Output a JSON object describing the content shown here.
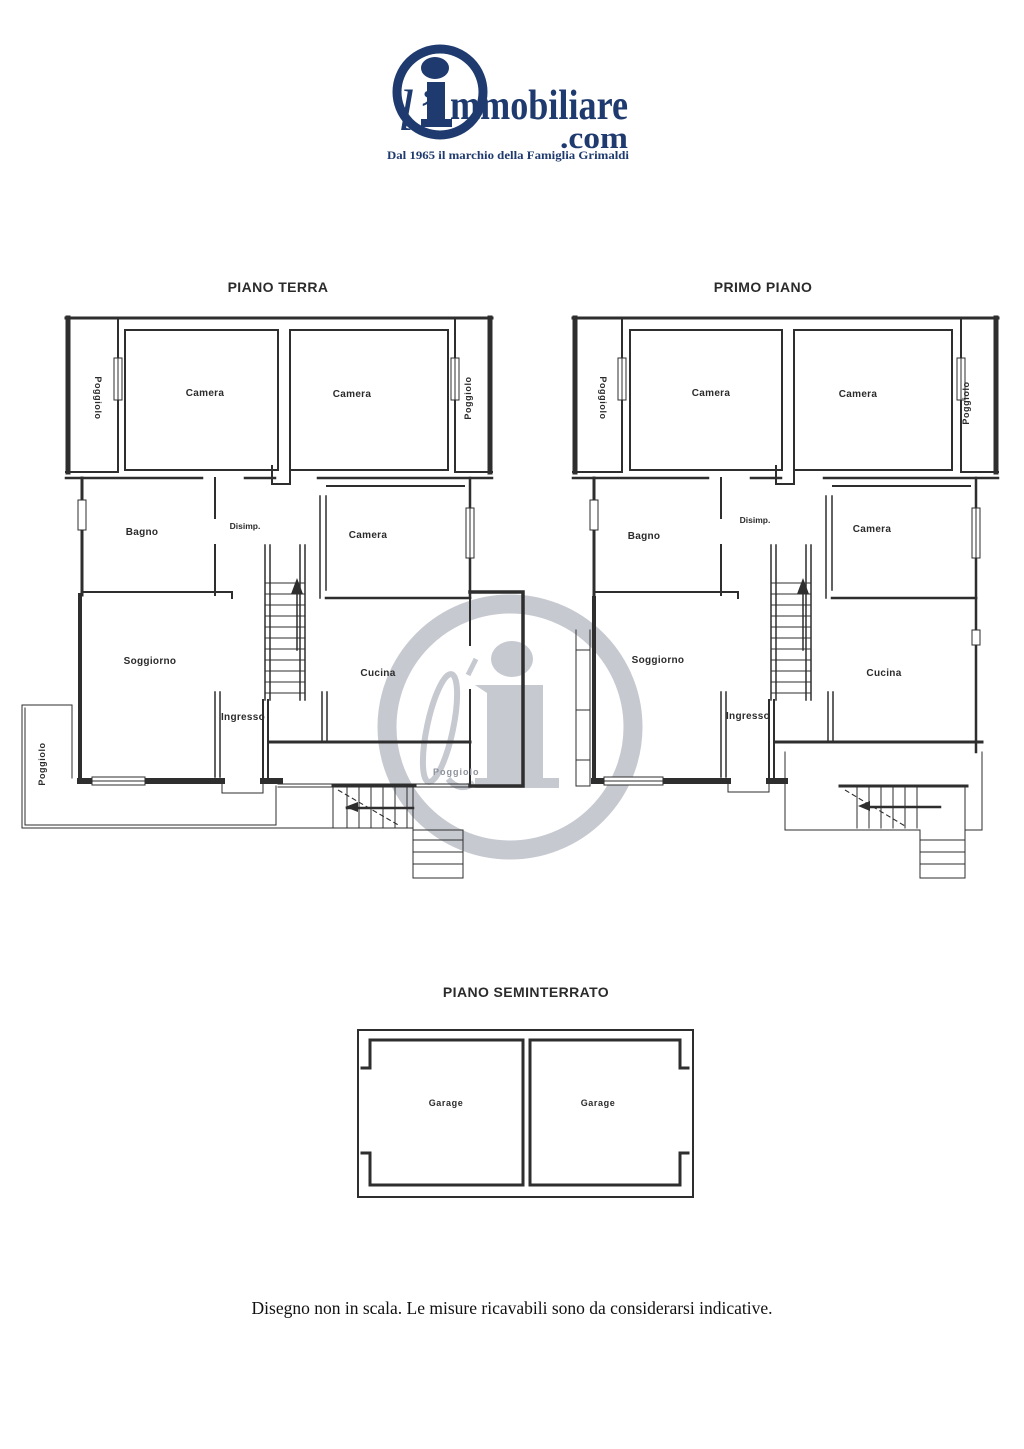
{
  "theme": {
    "navy": "#1e3a6e",
    "ink": "#2b2b2b",
    "line": "#2e2e2e",
    "muted": "#8d929b",
    "watermark": "#c6c9d0",
    "bg": "#ffffff"
  },
  "logo": {
    "script_prefix": "l’",
    "brand": "mmobiliare",
    "tld": ".com",
    "tagline": "Dal 1965 il marchio della Famiglia Grimaldi"
  },
  "floors": {
    "terra": {
      "title": "PIANO TERRA",
      "labels": {
        "camera_nw": "Camera",
        "camera_ne": "Camera",
        "bagno": "Bagno",
        "disimpegno": "Disimp.",
        "camera_e": "Camera",
        "soggiorno": "Soggiorno",
        "ingresso": "Ingresso",
        "cucina": "Cucina",
        "poggiolo_left": "Poggiolo",
        "poggiolo_right": "Poggiolo",
        "poggiolo_sw": "Poggiolo",
        "poggiolo_terrace": "Poggiolo"
      }
    },
    "primo": {
      "title": "PRIMO PIANO",
      "labels": {
        "camera_nw": "Camera",
        "camera_ne": "Camera",
        "bagno": "Bagno",
        "disimpegno": "Disimp.",
        "camera_e": "Camera",
        "soggiorno": "Soggiorno",
        "ingresso": "Ingresso",
        "cucina": "Cucina",
        "poggiolo_left": "Poggiolo",
        "poggiolo_right": "Poggiolo"
      }
    },
    "seminterrato": {
      "title": "PIANO SEMINTERRATO",
      "labels": {
        "garage_left": "Garage",
        "garage_right": "Garage"
      }
    }
  },
  "footer": {
    "note": "Disegno non in scala. Le misure ricavabili sono da considerarsi indicative."
  }
}
